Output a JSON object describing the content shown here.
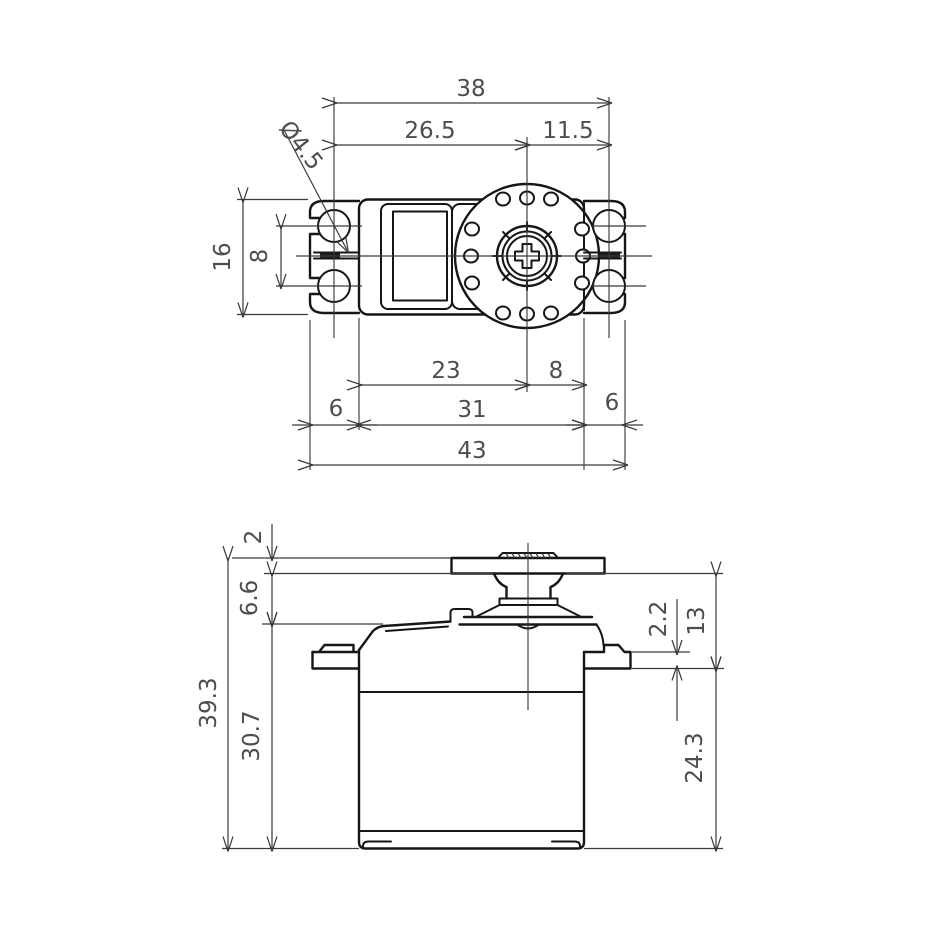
{
  "drawing": {
    "background_color": "#ffffff",
    "outline_color": "#161616",
    "dimension_line_color": "#3a3a3a",
    "dimension_text_color": "#4d4d4d"
  },
  "top_view": {
    "dim_mount_hole_span": "38",
    "dim_hole_to_shaft_left": "26.5",
    "dim_shaft_to_hole_right": "11.5",
    "dim_tab_hole_diameter": "Ø4.5",
    "dim_case_width": "16",
    "dim_tab_hole_pitch": "8",
    "dim_body_left_to_shaft": "23",
    "dim_shaft_to_body_right": "8",
    "dim_tab_left": "6",
    "dim_body_length": "31",
    "dim_tab_right": "6",
    "dim_overall_length": "43"
  },
  "front_view": {
    "dim_horn_thickness": "2",
    "dim_horn_to_case_top": "6.6",
    "dim_overall_height": "39.3",
    "dim_case_height": "30.7",
    "dim_flange_thickness": "2.2",
    "dim_horn_to_flange": "13",
    "dim_flange_to_bottom": "24.3"
  }
}
